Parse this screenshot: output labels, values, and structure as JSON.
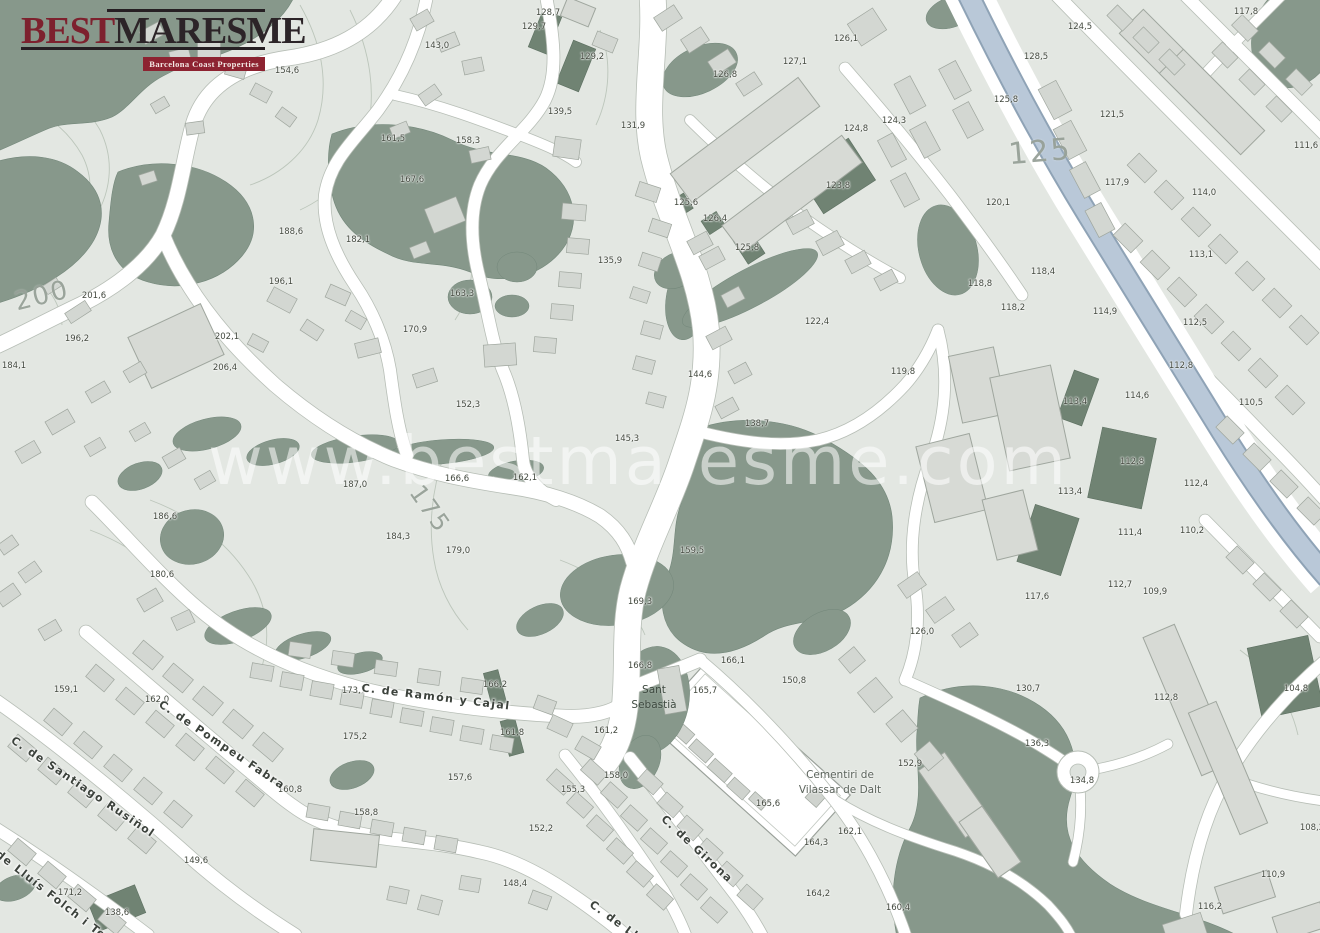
{
  "branding": {
    "best": "Best",
    "maresme": "Maresme",
    "best_display": "BEST",
    "maresme_display": "MARESME",
    "tagline": "Barcelona Coast Properties"
  },
  "watermark": "www.bestmaresme.com",
  "colors": {
    "background": "#e3e7e2",
    "building": "#d4d8d3",
    "building_stroke": "#9fa69e",
    "green_area": "#87988b",
    "green_plot": "#708373",
    "road": "#ffffff",
    "road_casing": "#b7beb6",
    "water": "#b9c8d8",
    "water_casing": "#8fa3b6",
    "contour": "#bcc5bb",
    "logo_red": "#7d212e",
    "logo_dark": "#2c2428",
    "badge_red": "#8d2331"
  },
  "map": {
    "streets": [
      {
        "t": "C. de Ramón y Cajal",
        "x": 436,
        "y": 697,
        "r": 7
      },
      {
        "t": "C. de Pompeu Fabra",
        "x": 222,
        "y": 745,
        "r": 34
      },
      {
        "t": "C. de Santiago Rusiñol",
        "x": 83,
        "y": 787,
        "r": 34
      },
      {
        "t": "C. de Lluís Folch i Torres",
        "x": 55,
        "y": 898,
        "r": 38
      },
      {
        "t": "C. de Girona",
        "x": 697,
        "y": 849,
        "r": 43
      },
      {
        "t": "C. de Ll",
        "x": 614,
        "y": 920,
        "r": 36
      }
    ],
    "places": [
      {
        "l1": "Sant",
        "l2": "Sebastià",
        "x": 654,
        "y": 698,
        "cls": "place-green"
      },
      {
        "l1": "Cementiri de",
        "l2": "Vilassar de Dalt",
        "x": 840,
        "y": 783,
        "cls": "place-gray"
      }
    ],
    "contour_labels": [
      {
        "t": "200",
        "x": 42,
        "y": 296,
        "r": -14,
        "s": 26
      },
      {
        "t": "175",
        "x": 430,
        "y": 509,
        "r": 55,
        "s": 24
      },
      {
        "t": "125",
        "x": 1040,
        "y": 152,
        "r": -5,
        "s": 30
      }
    ],
    "elevations": [
      {
        "t": "154,6",
        "x": 287,
        "y": 71
      },
      {
        "t": "143,0",
        "x": 437,
        "y": 46
      },
      {
        "t": "129,7",
        "x": 534,
        "y": 27
      },
      {
        "t": "128,7",
        "x": 548,
        "y": 13
      },
      {
        "t": "129,2",
        "x": 592,
        "y": 57
      },
      {
        "t": "139,5",
        "x": 560,
        "y": 112
      },
      {
        "t": "161,5",
        "x": 393,
        "y": 139
      },
      {
        "t": "158,3",
        "x": 468,
        "y": 141
      },
      {
        "t": "167,6",
        "x": 412,
        "y": 180
      },
      {
        "t": "131,9",
        "x": 633,
        "y": 126
      },
      {
        "t": "135,9",
        "x": 610,
        "y": 261
      },
      {
        "t": "163,3",
        "x": 462,
        "y": 294
      },
      {
        "t": "170,9",
        "x": 415,
        "y": 330
      },
      {
        "t": "152,3",
        "x": 468,
        "y": 405
      },
      {
        "t": "182,1",
        "x": 358,
        "y": 240
      },
      {
        "t": "188,6",
        "x": 291,
        "y": 232
      },
      {
        "t": "196,1",
        "x": 281,
        "y": 282
      },
      {
        "t": "201,6",
        "x": 94,
        "y": 296
      },
      {
        "t": "196,2",
        "x": 77,
        "y": 339
      },
      {
        "t": "184,1",
        "x": 14,
        "y": 366
      },
      {
        "t": "202,1",
        "x": 227,
        "y": 337
      },
      {
        "t": "206,4",
        "x": 225,
        "y": 368
      },
      {
        "t": "186,6",
        "x": 165,
        "y": 517
      },
      {
        "t": "180,6",
        "x": 162,
        "y": 575
      },
      {
        "t": "187,0",
        "x": 355,
        "y": 485
      },
      {
        "t": "166,6",
        "x": 457,
        "y": 479
      },
      {
        "t": "162,1",
        "x": 525,
        "y": 478
      },
      {
        "t": "184,3",
        "x": 398,
        "y": 537
      },
      {
        "t": "179,0",
        "x": 458,
        "y": 551
      },
      {
        "t": "144,6",
        "x": 700,
        "y": 375
      },
      {
        "t": "138,7",
        "x": 757,
        "y": 424
      },
      {
        "t": "145,3",
        "x": 627,
        "y": 439
      },
      {
        "t": "159,5",
        "x": 692,
        "y": 551
      },
      {
        "t": "169,3",
        "x": 640,
        "y": 602
      },
      {
        "t": "126,8",
        "x": 725,
        "y": 75
      },
      {
        "t": "127,1",
        "x": 795,
        "y": 62
      },
      {
        "t": "126,1",
        "x": 846,
        "y": 39
      },
      {
        "t": "124,8",
        "x": 856,
        "y": 129
      },
      {
        "t": "124,3",
        "x": 894,
        "y": 121
      },
      {
        "t": "125,6",
        "x": 686,
        "y": 203
      },
      {
        "t": "126,4",
        "x": 715,
        "y": 219
      },
      {
        "t": "125,8",
        "x": 747,
        "y": 248
      },
      {
        "t": "123,8",
        "x": 838,
        "y": 186
      },
      {
        "t": "122,4",
        "x": 817,
        "y": 322
      },
      {
        "t": "119,8",
        "x": 903,
        "y": 372
      },
      {
        "t": "124,5",
        "x": 1080,
        "y": 27
      },
      {
        "t": "128,5",
        "x": 1036,
        "y": 57
      },
      {
        "t": "125,8",
        "x": 1006,
        "y": 100
      },
      {
        "t": "121,5",
        "x": 1112,
        "y": 115
      },
      {
        "t": "117,8",
        "x": 1246,
        "y": 12
      },
      {
        "t": "111,6",
        "x": 1306,
        "y": 146
      },
      {
        "t": "117,9",
        "x": 1117,
        "y": 183
      },
      {
        "t": "120,1",
        "x": 998,
        "y": 203
      },
      {
        "t": "114,0",
        "x": 1204,
        "y": 193
      },
      {
        "t": "113,1",
        "x": 1201,
        "y": 255
      },
      {
        "t": "118,4",
        "x": 1043,
        "y": 272
      },
      {
        "t": "118,8",
        "x": 980,
        "y": 284
      },
      {
        "t": "118,2",
        "x": 1013,
        "y": 308
      },
      {
        "t": "114,9",
        "x": 1105,
        "y": 312
      },
      {
        "t": "112,5",
        "x": 1195,
        "y": 323
      },
      {
        "t": "112,8",
        "x": 1181,
        "y": 366
      },
      {
        "t": "114,6",
        "x": 1137,
        "y": 396
      },
      {
        "t": "113,4",
        "x": 1075,
        "y": 402
      },
      {
        "t": "110,5",
        "x": 1251,
        "y": 403
      },
      {
        "t": "112,8",
        "x": 1132,
        "y": 462
      },
      {
        "t": "113,4",
        "x": 1070,
        "y": 492
      },
      {
        "t": "112,4",
        "x": 1196,
        "y": 484
      },
      {
        "t": "110,2",
        "x": 1192,
        "y": 531
      },
      {
        "t": "111,4",
        "x": 1130,
        "y": 533
      },
      {
        "t": "104,8",
        "x": 1296,
        "y": 689
      },
      {
        "t": "109,9",
        "x": 1155,
        "y": 592
      },
      {
        "t": "112,7",
        "x": 1120,
        "y": 585
      },
      {
        "t": "117,6",
        "x": 1037,
        "y": 597
      },
      {
        "t": "126,0",
        "x": 922,
        "y": 632
      },
      {
        "t": "130,7",
        "x": 1028,
        "y": 689
      },
      {
        "t": "112,8",
        "x": 1166,
        "y": 698
      },
      {
        "t": "136,3",
        "x": 1037,
        "y": 744
      },
      {
        "t": "134,8",
        "x": 1082,
        "y": 781
      },
      {
        "t": "108,2",
        "x": 1312,
        "y": 828
      },
      {
        "t": "110,9",
        "x": 1273,
        "y": 875
      },
      {
        "t": "116,2",
        "x": 1210,
        "y": 907
      },
      {
        "t": "166,8",
        "x": 640,
        "y": 666
      },
      {
        "t": "166,1",
        "x": 733,
        "y": 661
      },
      {
        "t": "165,7",
        "x": 705,
        "y": 691
      },
      {
        "t": "150,8",
        "x": 794,
        "y": 681
      },
      {
        "t": "161,2",
        "x": 606,
        "y": 731
      },
      {
        "t": "152,9",
        "x": 910,
        "y": 764
      },
      {
        "t": "165,6",
        "x": 768,
        "y": 804
      },
      {
        "t": "164,3",
        "x": 816,
        "y": 843
      },
      {
        "t": "162,1",
        "x": 850,
        "y": 832
      },
      {
        "t": "164,2",
        "x": 818,
        "y": 894
      },
      {
        "t": "160,4",
        "x": 898,
        "y": 908
      },
      {
        "t": "158,0",
        "x": 616,
        "y": 776
      },
      {
        "t": "155,3",
        "x": 573,
        "y": 790
      },
      {
        "t": "152,2",
        "x": 541,
        "y": 829
      },
      {
        "t": "157,6",
        "x": 460,
        "y": 778
      },
      {
        "t": "161,8",
        "x": 512,
        "y": 733
      },
      {
        "t": "166,2",
        "x": 495,
        "y": 685
      },
      {
        "t": "148,4",
        "x": 515,
        "y": 884
      },
      {
        "t": "149,6",
        "x": 196,
        "y": 861
      },
      {
        "t": "138,6",
        "x": 117,
        "y": 913
      },
      {
        "t": "171,2",
        "x": 70,
        "y": 893
      },
      {
        "t": "159,1",
        "x": 66,
        "y": 690
      },
      {
        "t": "162,0",
        "x": 157,
        "y": 700
      },
      {
        "t": "173,7",
        "x": 354,
        "y": 691
      },
      {
        "t": "175,2",
        "x": 355,
        "y": 737
      },
      {
        "t": "160,8",
        "x": 290,
        "y": 790
      },
      {
        "t": "158,8",
        "x": 366,
        "y": 813
      }
    ]
  }
}
